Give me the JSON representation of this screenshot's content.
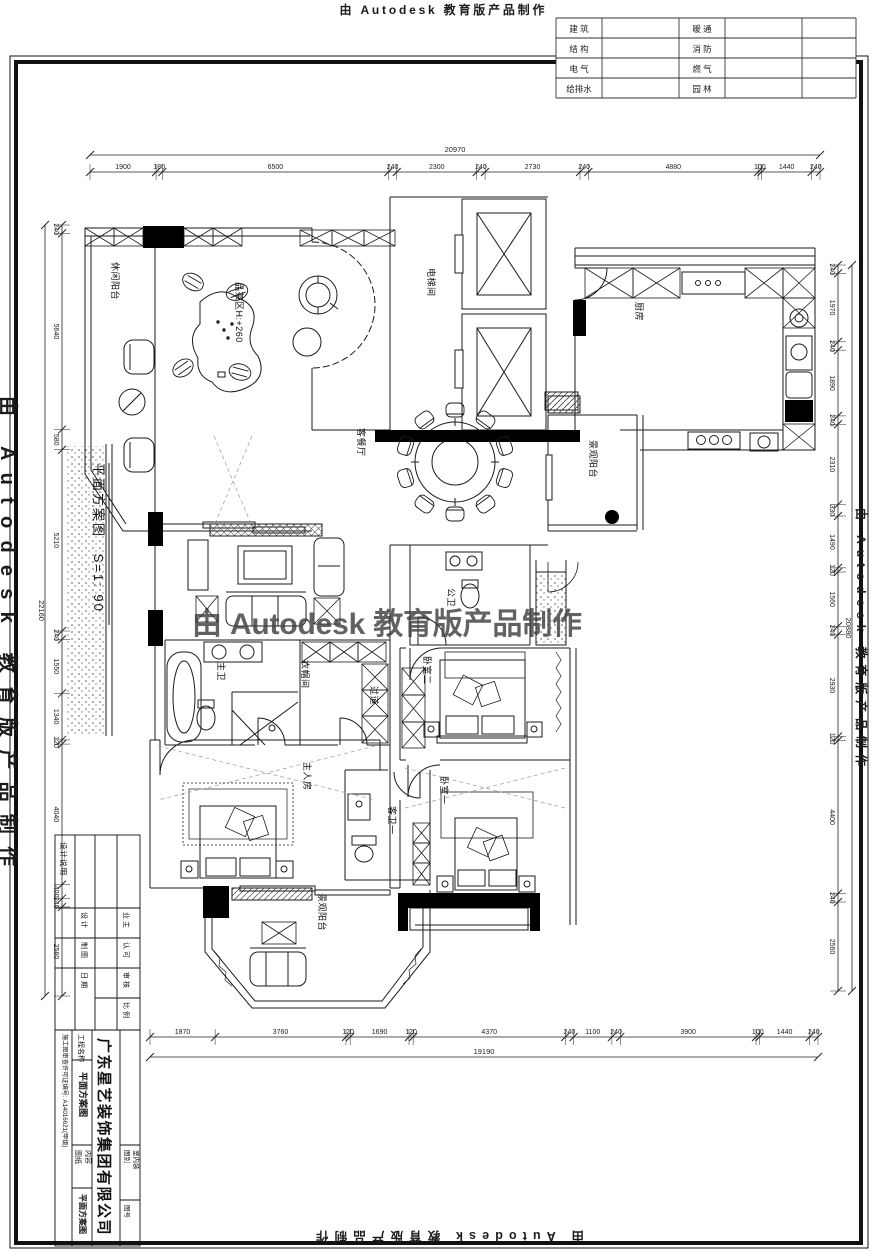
{
  "watermark": {
    "text": "由 Autodesk 教育版产品制作"
  },
  "discipline_table": {
    "rows": [
      {
        "left": "建 筑",
        "right": "暖 通"
      },
      {
        "left": "结 构",
        "right": "消 防"
      },
      {
        "left": "电 气",
        "right": "燃 气"
      },
      {
        "left": "给排水",
        "right": "园 林"
      }
    ]
  },
  "plan": {
    "title": "平面方案图",
    "scale": "S=1: 90",
    "rooms": [
      {
        "label": "休闲阳台",
        "x": 112,
        "y": 262
      },
      {
        "label": "品茶区H:+260",
        "x": 236,
        "y": 282
      },
      {
        "label": "电梯间",
        "x": 428,
        "y": 268
      },
      {
        "label": "厨房",
        "x": 636,
        "y": 302
      },
      {
        "label": "客餐厅",
        "x": 358,
        "y": 428
      },
      {
        "label": "景观阳台",
        "x": 590,
        "y": 440
      },
      {
        "label": "公卫",
        "x": 448,
        "y": 588
      },
      {
        "label": "主卫",
        "x": 218,
        "y": 662
      },
      {
        "label": "衣帽间",
        "x": 302,
        "y": 660
      },
      {
        "label": "过道",
        "x": 371,
        "y": 686
      },
      {
        "label": "卧室二",
        "x": 424,
        "y": 656
      },
      {
        "label": "卧室一",
        "x": 441,
        "y": 776
      },
      {
        "label": "客卫一",
        "x": 389,
        "y": 806
      },
      {
        "label": "主人房",
        "x": 304,
        "y": 762
      },
      {
        "label": "景观阳台",
        "x": 319,
        "y": 893
      }
    ]
  },
  "dimensions": {
    "top": {
      "total": "20970",
      "segments": [
        "1900",
        "180",
        "6500",
        "240",
        "2300",
        "240",
        "2730",
        "240",
        "4880",
        "100",
        "1440",
        "240"
      ]
    },
    "bottom": {
      "total": "19190",
      "segments": [
        "1870",
        "3760",
        "120",
        "1690",
        "120",
        "4370",
        "240",
        "1100",
        "240",
        "3900",
        "100",
        "1440",
        "240"
      ]
    },
    "left": {
      "total": "22160",
      "segments": [
        "240",
        "5640",
        "580",
        "5210",
        "240",
        "1550",
        "1340",
        "120",
        "4040",
        "400",
        "240",
        "2560"
      ]
    },
    "right": {
      "total": "20880",
      "segments": [
        "240",
        "1970",
        "240",
        "1890",
        "240",
        "2310",
        "330",
        "1490",
        "120",
        "1560",
        "240",
        "2930",
        "120",
        "4400",
        "240",
        "2560"
      ]
    }
  },
  "title_block": {
    "design_note": "设计说明",
    "rows_left": [
      "设 计",
      "制 图",
      "日 期"
    ],
    "rows_right": [
      "业 主",
      "认 可",
      "审 核",
      "比 例"
    ],
    "company": "广东星艺装饰集团有限公司",
    "project_label": "工程名称",
    "project_value": "平面方案图",
    "license": "施工图审查许可证编号: A14016621(甲级)",
    "sheet_label_1": "图纸",
    "sheet_label_2": "内容",
    "sheet_value": "平面方案图",
    "type_label": "图别",
    "type_value": "室内装",
    "number_label": "图号"
  }
}
